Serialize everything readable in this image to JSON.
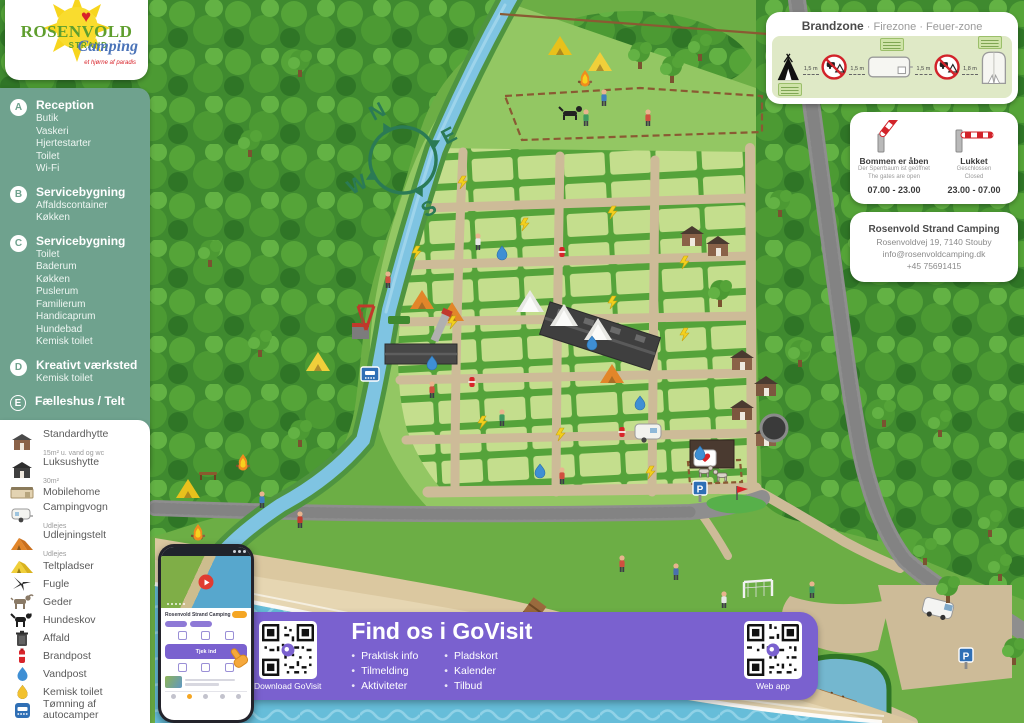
{
  "logo": {
    "name": "ROSENVOLD",
    "heart": "♥",
    "strand": "STRAND",
    "camping": "Camping",
    "tagline": "et hjørne af paradis"
  },
  "legend_green": {
    "items": [
      {
        "marker": "A",
        "title": "Reception",
        "details": [
          "Butik",
          "Vaskeri",
          "Hjertestarter",
          "Toilet",
          "Wi-Fi"
        ]
      },
      {
        "marker": "B",
        "title": "Servicebygning",
        "details": [
          "Affaldscontainer",
          "Køkken"
        ]
      },
      {
        "marker": "C",
        "title": "Servicebygning",
        "details": [
          "Toilet",
          "Baderum",
          "Køkken",
          "Puslerum",
          "Familierum",
          "Handicaprum",
          "Hundebad",
          "Kemisk toilet"
        ]
      },
      {
        "marker": "D",
        "title": "Kreativt værksted",
        "details": [
          "Kemisk toilet"
        ]
      },
      {
        "marker": "E",
        "title": "Fælleshus / Telt",
        "details": []
      },
      {
        "marker": "1",
        "title": "Materialegård",
        "details": []
      },
      {
        "marker": "2",
        "title": "Marina",
        "details": []
      }
    ]
  },
  "legend_white": {
    "items": [
      {
        "label": "Standardhytte",
        "sub": "15m² u. vand og wc"
      },
      {
        "label": "Luksushytte",
        "sub": "30m²"
      },
      {
        "label": "Mobilehome",
        "sub": ""
      },
      {
        "label": "Campingvogn",
        "sub": "Udlejes"
      },
      {
        "label": "Udlejningstelt",
        "sub": "Udlejes"
      },
      {
        "label": "Teltpladser",
        "sub": ""
      },
      {
        "label": "Fugle",
        "sub": ""
      },
      {
        "label": "Geder",
        "sub": ""
      },
      {
        "label": "Hundeskov",
        "sub": ""
      },
      {
        "label": "Affald",
        "sub": ""
      },
      {
        "label": "Brandpost",
        "sub": ""
      },
      {
        "label": "Vandpost",
        "sub": ""
      },
      {
        "label": "Kemisk toilet",
        "sub": ""
      },
      {
        "label": "Tømning af autocamper",
        "sub": ""
      }
    ]
  },
  "brandzone": {
    "title": "Brandzone",
    "subtitle": "· Firezone · Feuer-zone",
    "distances": [
      "1,5 m",
      "1,5 m",
      "1,5 m",
      "1,8 m"
    ]
  },
  "barrier": {
    "open": {
      "title": "Bommen er åben",
      "de": "Der Sperrbaum ist geöffnet",
      "en": "The gates are open",
      "hours": "07.00 - 23.00"
    },
    "closed": {
      "title": "Lukket",
      "de": "Geschlossen",
      "en": "Closed",
      "hours": "23.00 - 07.00"
    }
  },
  "contact": {
    "name": "Rosenvold Strand Camping",
    "address": "Rosenvoldvej 19, 7140 Stouby",
    "email": "info@rosenvoldcamping.dk",
    "phone": "+45 75691415"
  },
  "govisit": {
    "title": "Find os i GoVisit",
    "bullets_left": [
      "Praktisk info",
      "Tilmelding",
      "Aktiviteter"
    ],
    "bullets_right": [
      "Pladskort",
      "Kalender",
      "Tilbud"
    ],
    "qr_left_label": "Download GoVisit",
    "qr_right_label": "Web app"
  },
  "phone": {
    "app_title": "Rosenvold Strand Camping",
    "checkin_button": "Tjek ind"
  },
  "compass": {
    "n": "N",
    "e": "E",
    "s": "S",
    "w": "W"
  },
  "map_labels": {
    "parking": "P"
  },
  "colors": {
    "panel_green": "#6fa28e",
    "purple": "#7a61cf",
    "grass": "#6cae45",
    "plot": "#c4de8d",
    "hedge": "#55a33a",
    "road_tan": "#cdbb98",
    "road_gravel": "#8e8e8e",
    "sea": "#66bdd9",
    "sand": "#dbc8a0",
    "river": "#7fc4e2",
    "accent_red": "#d8232a",
    "sign_blue": "#2f6fb5"
  }
}
